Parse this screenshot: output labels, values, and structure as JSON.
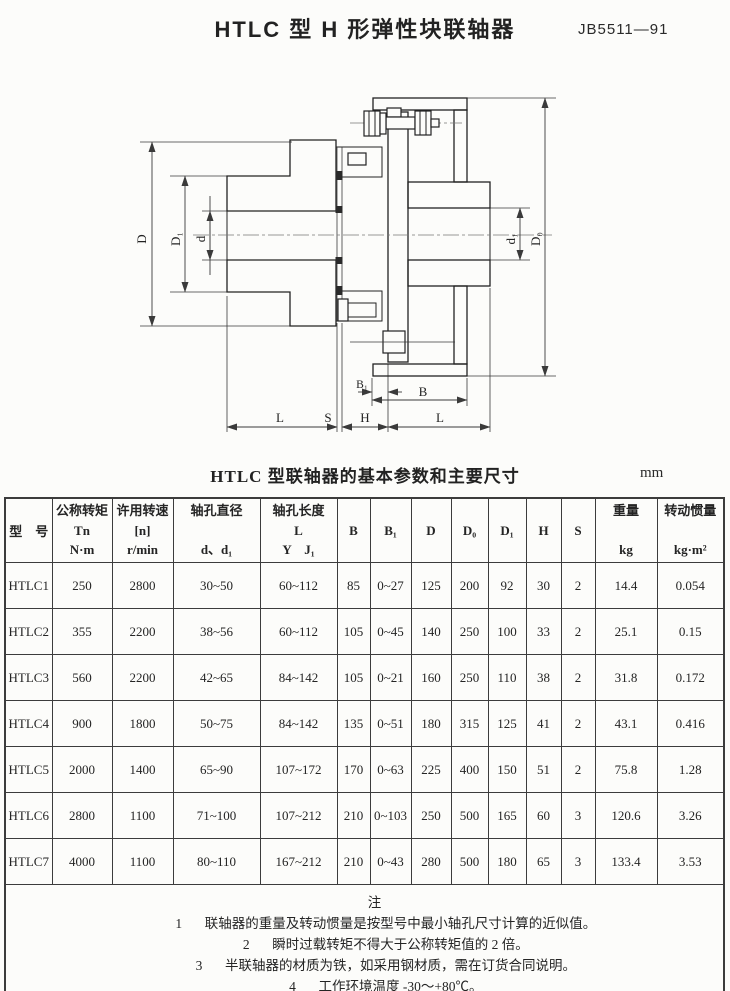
{
  "page": {
    "title": "HTLC 型 H 形弹性块联轴器",
    "standard_no": "JB5511—91"
  },
  "drawing": {
    "labels": {
      "D": "D",
      "D1": "D₁",
      "d": "d",
      "d1": "d₁",
      "D0": "D₀",
      "B1": "B₁",
      "B": "B",
      "L_left": "L",
      "S": "S",
      "H": "H",
      "L_right": "L"
    }
  },
  "table": {
    "caption": "HTLC 型联轴器的基本参数和主要尺寸",
    "unit": "mm",
    "header": {
      "model": "型　号",
      "torque": [
        "公称转矩",
        "Tn",
        "N·m"
      ],
      "speed": [
        "许用转速",
        "[n]",
        "r/min"
      ],
      "bore_dia": [
        "轴孔直径",
        "",
        "d、d₁"
      ],
      "bore_len": [
        "轴孔长度",
        "L",
        "Y　J₁"
      ],
      "B": "B",
      "B1": "B₁",
      "D": "D",
      "D0": "D₀",
      "D1": "D₁",
      "H": "H",
      "S": "S",
      "weight": [
        "重量",
        "",
        "kg"
      ],
      "inertia": [
        "转动惯量",
        "",
        "kg·m²"
      ]
    },
    "rows": [
      [
        "HTLC1",
        "250",
        "2800",
        "30~50",
        "60~112",
        "85",
        "0~27",
        "125",
        "200",
        "92",
        "30",
        "2",
        "14.4",
        "0.054"
      ],
      [
        "HTLC2",
        "355",
        "2200",
        "38~56",
        "60~112",
        "105",
        "0~45",
        "140",
        "250",
        "100",
        "33",
        "2",
        "25.1",
        "0.15"
      ],
      [
        "HTLC3",
        "560",
        "2200",
        "42~65",
        "84~142",
        "105",
        "0~21",
        "160",
        "250",
        "110",
        "38",
        "2",
        "31.8",
        "0.172"
      ],
      [
        "HTLC4",
        "900",
        "1800",
        "50~75",
        "84~142",
        "135",
        "0~51",
        "180",
        "315",
        "125",
        "41",
        "2",
        "43.1",
        "0.416"
      ],
      [
        "HTLC5",
        "2000",
        "1400",
        "65~90",
        "107~172",
        "170",
        "0~63",
        "225",
        "400",
        "150",
        "51",
        "2",
        "75.8",
        "1.28"
      ],
      [
        "HTLC6",
        "2800",
        "1100",
        "71~100",
        "107~212",
        "210",
        "0~103",
        "250",
        "500",
        "165",
        "60",
        "3",
        "120.6",
        "3.26"
      ],
      [
        "HTLC7",
        "4000",
        "1100",
        "80~110",
        "167~212",
        "210",
        "0~43",
        "280",
        "500",
        "180",
        "65",
        "3",
        "133.4",
        "3.53"
      ]
    ]
  },
  "notes": {
    "heading": "注",
    "items": [
      {
        "no": "1",
        "text": "联轴器的重量及转动惯量是按型号中最小轴孔尺寸计算的近似值。"
      },
      {
        "no": "2",
        "text": "瞬时过载转矩不得大于公称转矩值的 2 倍。"
      },
      {
        "no": "3",
        "text": "半联轴器的材质为铁，如采用钢材质，需在订货合同说明。"
      },
      {
        "no": "4",
        "text": "工作环境温度 -30～+80℃。"
      }
    ]
  }
}
